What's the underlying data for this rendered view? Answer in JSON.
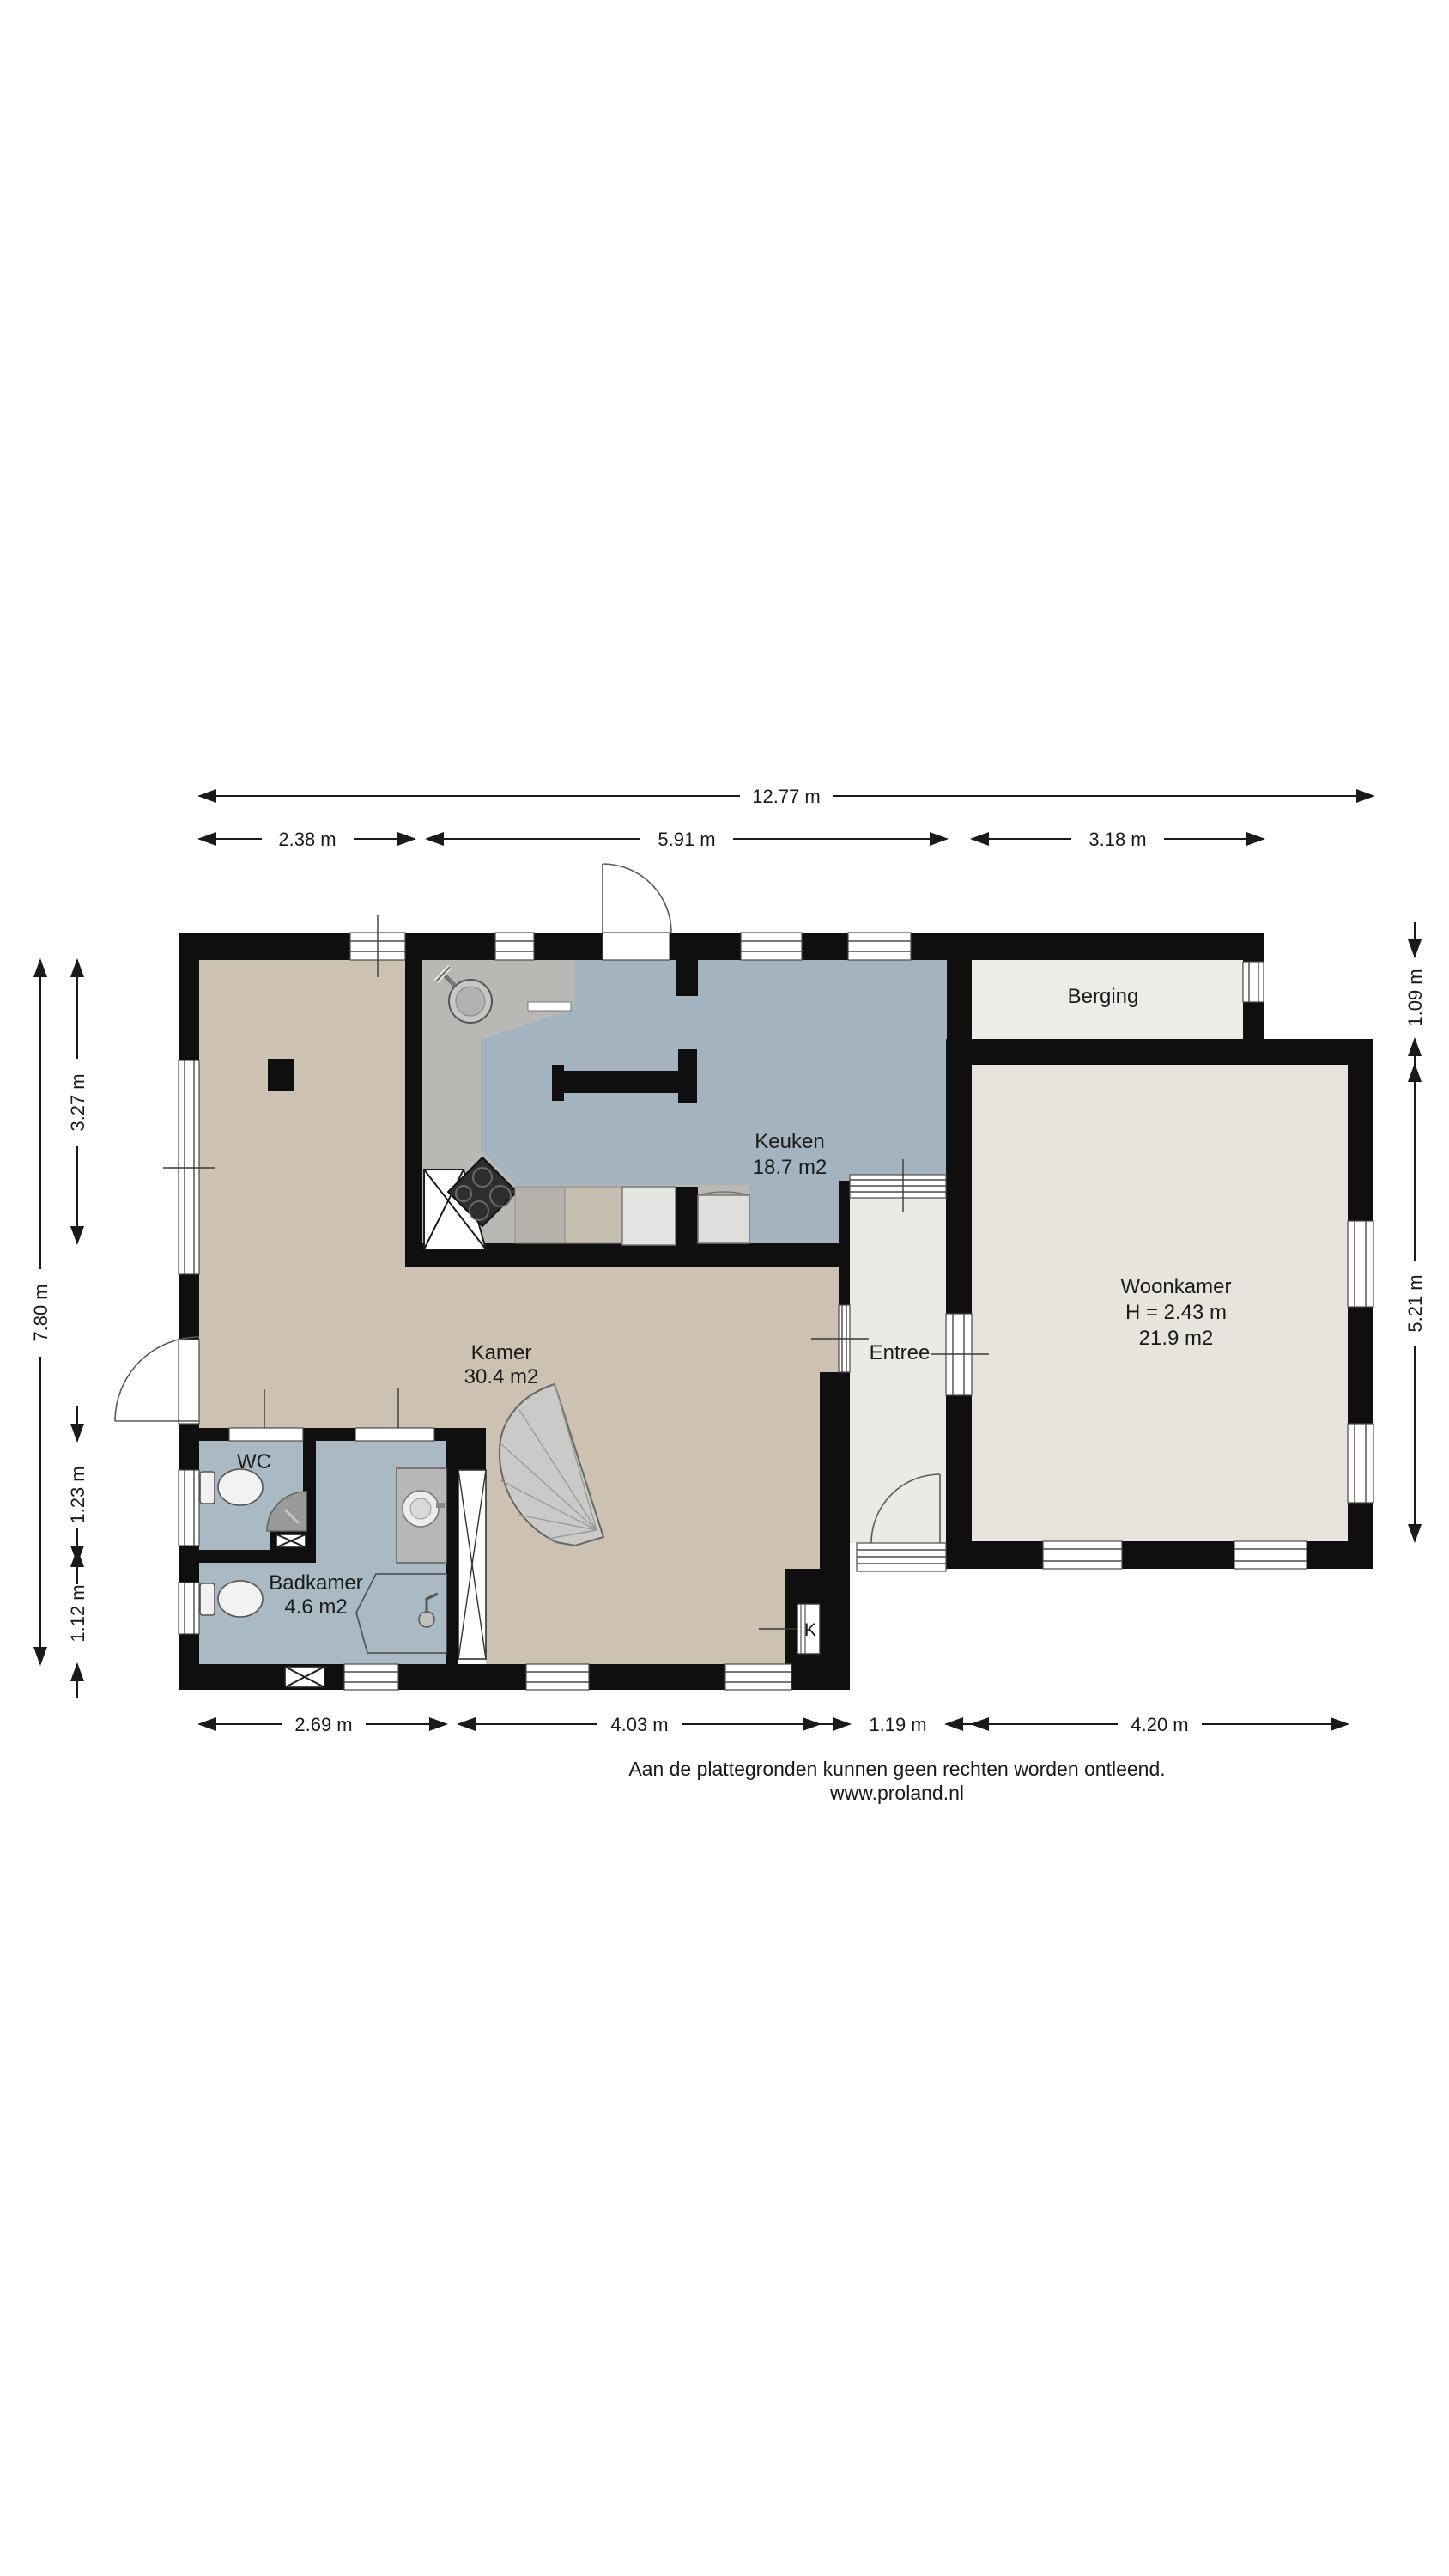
{
  "footer": {
    "line1": "Aan de plattegronden kunnen geen rechten worden ontleend.",
    "line2": "www.proland.nl"
  },
  "rooms": {
    "keuken": {
      "name": "Keuken",
      "area": "18.7 m2"
    },
    "berging": {
      "name": "Berging"
    },
    "woonkamer": {
      "name": "Woonkamer",
      "height": "H =  2.43 m",
      "area": "21.9 m2"
    },
    "entree": {
      "name": "Entree"
    },
    "kamer": {
      "name": "Kamer",
      "area": "30.4 m2"
    },
    "wc": {
      "name": "WC"
    },
    "badkamer": {
      "name": "Badkamer",
      "area": "4.6 m2"
    },
    "kast": {
      "label": "K"
    }
  },
  "dimensions": {
    "top_total": "12.77 m",
    "top_left": "2.38 m",
    "top_mid": "5.91 m",
    "top_right": "3.18 m",
    "left_total": "7.80 m",
    "left_top": "3.27 m",
    "left_wc": "1.23 m",
    "left_bad": "1.12 m",
    "right_berging": "1.09 m",
    "right_woonkamer": "5.21 m",
    "bottom_1": "2.69 m",
    "bottom_2": "4.03 m",
    "bottom_3": "1.19 m",
    "bottom_4": "4.20 m"
  },
  "colors": {
    "wall": "#0f0f0f",
    "kamer_floor": "#cdc2b1",
    "keuken_floor": "#a3b4c0",
    "work_floor": "#b9b8b4",
    "bad_floor": "#a9bac4",
    "woonkamer_floor": "#e7e4dd",
    "berging_floor": "#edece8",
    "entree_floor": "#eceae5",
    "stairs": "#cbcac8"
  }
}
